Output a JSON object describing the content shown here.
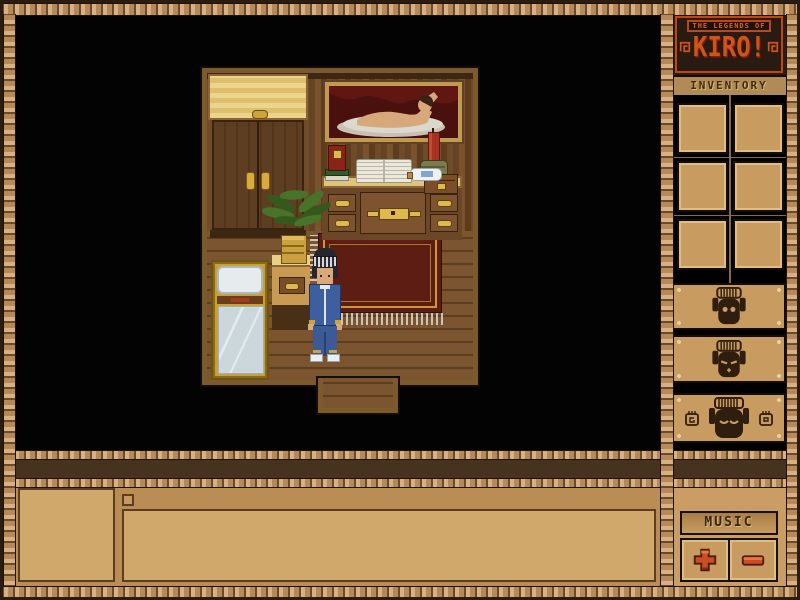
{
  "logo": {
    "tagline": "THE LEGENDS OF",
    "title": "KIRO!"
  },
  "sidebar": {
    "inventory_label": "INVENTORY",
    "inventory_slots": [
      {
        "index": 1,
        "item": ""
      },
      {
        "index": 2,
        "item": ""
      },
      {
        "index": 3,
        "item": ""
      },
      {
        "index": 4,
        "item": ""
      },
      {
        "index": 5,
        "item": ""
      },
      {
        "index": 6,
        "item": ""
      }
    ],
    "mask_buttons": [
      {
        "icon": "tiki-mask-round-eyes-icon"
      },
      {
        "icon": "tiki-mask-slant-eyes-icon"
      },
      {
        "icon": "tiki-mask-wide-icon",
        "left_icon": "mini-mask-card-icon",
        "right_icon": "mini-mask-card-icon"
      }
    ],
    "music": {
      "label": "MUSIC",
      "volume_up_icon": "plus-icon",
      "volume_down_icon": "minus-icon"
    }
  },
  "message_bar": {
    "portrait_text": "",
    "checkbox_icon": "empty-square-icon",
    "message_text": ""
  },
  "scene": {
    "objects": [
      "wardrobe",
      "framed-nude-painting",
      "desk",
      "open-book",
      "book-stack",
      "candle",
      "jar",
      "bottle",
      "small-chest",
      "hanging-plant",
      "nightstand",
      "bed",
      "red-rug",
      "player-character",
      "doorway"
    ]
  },
  "colors": {
    "frame_rope": "#c9a06a",
    "panel_tan": "#c89c60",
    "panel_dark_tan": "#b98d53",
    "logo_orange": "#d0541a",
    "logo_bg": "#2b1d13",
    "button_red": "#c8501f",
    "mask_icon": "#2f1d0e",
    "rug_red": "#5e1d12",
    "background": "#000000"
  }
}
